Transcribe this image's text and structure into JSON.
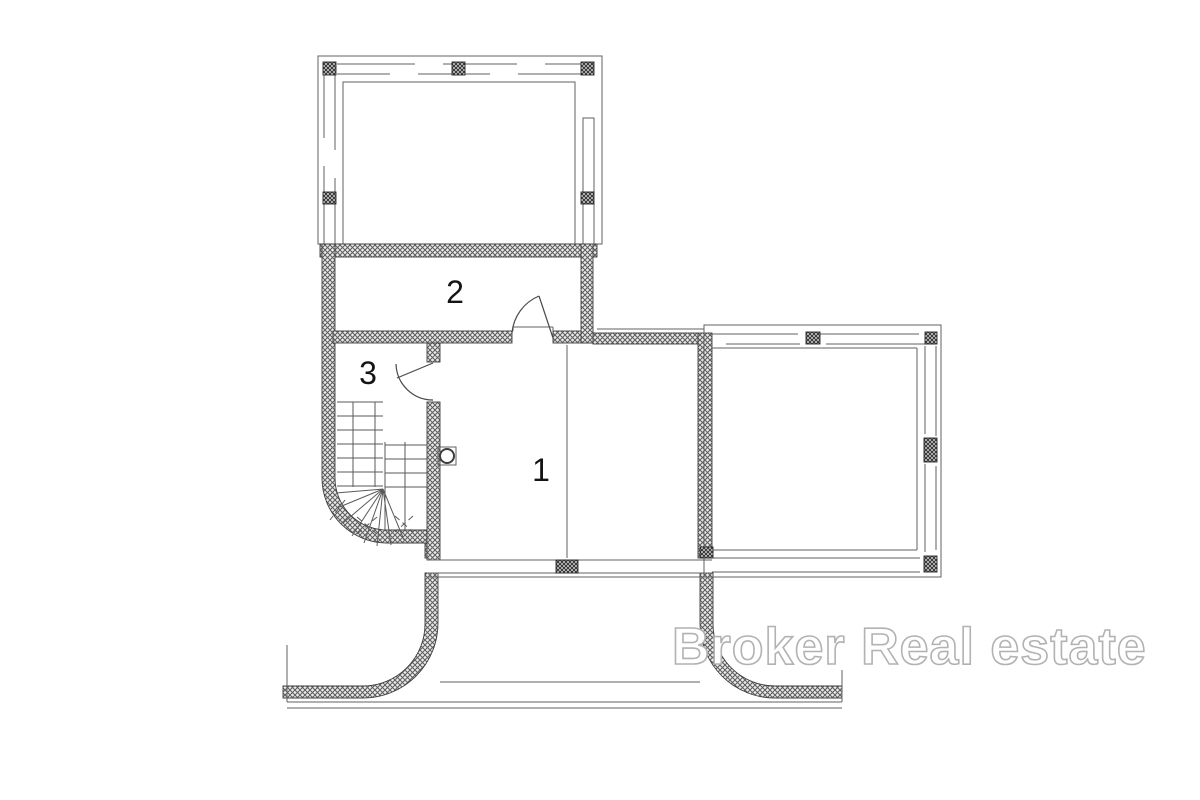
{
  "plan": {
    "type": "floor-plan",
    "rooms": [
      {
        "label": "1"
      },
      {
        "label": "2"
      },
      {
        "label": "3"
      }
    ],
    "features": [
      "upper-terrace",
      "right-terrace",
      "lower-terrace",
      "winder-staircase",
      "door-room-2",
      "door-room-3",
      "round-fixture"
    ]
  },
  "watermark": {
    "text": "Broker Real estate"
  },
  "colors": {
    "background": "#ffffff",
    "wall_hatch": "#5c5c5c",
    "line": "#4a4a4a",
    "watermark_fill": "#ffffff",
    "watermark_outline": "#b2b2b2"
  }
}
